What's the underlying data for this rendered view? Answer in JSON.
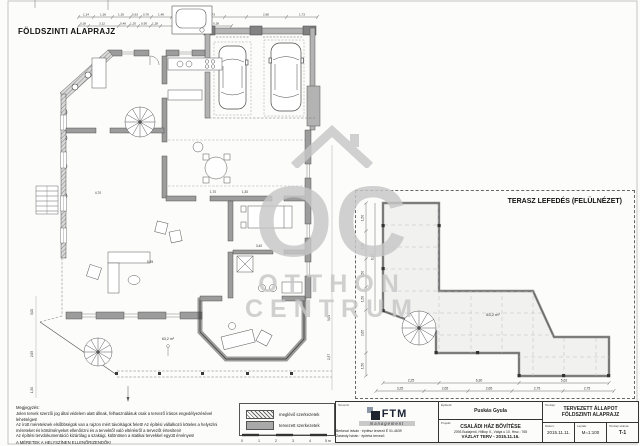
{
  "sheet": {
    "main_title": "FÖLDSZINTI ALAPRAJZ",
    "terrace_title": "TERASZ LEFEDÉS (FELÜLNÉZET)"
  },
  "watermark": {
    "oc": "OC",
    "line1": "OTTHON",
    "line2": "CENTRUM"
  },
  "main_plan": {
    "top_dims_row1": [
      "1,14",
      "1,36",
      "1,35",
      "0,63",
      "0,76",
      "1,48",
      "1,45",
      "0,74",
      "1,73",
      "2,80",
      "1,73"
    ],
    "top_dims_row2": [
      "0,38",
      "3,12",
      "0,48",
      "1,20",
      "0,90",
      "1,28",
      "2,39",
      "0,38"
    ],
    "area_label": "63,2 m²",
    "dims": {
      "d1": "1,70",
      "d2": "1,30",
      "d3": "3,40",
      "d4": "5,95",
      "d5": "4,70",
      "d6": "3,00",
      "d7": "2,65",
      "d8": "1,50",
      "d9": "3,04",
      "d10": "2,37"
    }
  },
  "terrace_plan": {
    "area_label": "63,2 m²",
    "bottom_dims_row1": [
      "2,25",
      "6,30",
      "5,62"
    ],
    "bottom_dims_row2": [
      "3,25",
      "2,65",
      "2,65",
      "2,75",
      "2,75"
    ],
    "left_dims": [
      "1,50",
      "1,50",
      "1,50",
      "1,50",
      "2,65",
      "1,50"
    ],
    "left_total": "6,92"
  },
  "notes": {
    "heading": "Megjegyzés:",
    "line1": "Jelen tervek szerzői jog által védelem alatt állnak, felhasználásuk csak a tervező írásos engedélyezésével lehetséges!",
    "line2": "Az írott méreteknek elsőbbségük van a rajzon mért távolságok felett! Az építési vállalkozó köteles a helyszíni méreteket és körülményeket ellenőrizni és a tervektől való eltérésről a tervezőt értesíteni!",
    "line3": "Az építési tervdokumentáció kizárólag a szakági, különösen a statikai tervekkel együtt érvényes!",
    "line4": "A MÉRETEK A HELYSZÍNEN ELLENŐRIZENDŐK!"
  },
  "legend": {
    "existing": "meglévő szerkezetek",
    "planned": "tervezett szerkezetek",
    "scale_numbers": [
      "0",
      "1",
      "2",
      "3",
      "4",
      "5 m"
    ]
  },
  "title_block": {
    "designer_label": "Tervező:",
    "logo_text": "FTM",
    "logo_sub": "management",
    "designer_line1": "Berkeczi István · építész tervező É 01-4639",
    "designer_line2": "Zarándy István · építész tervező",
    "client_label": "Építtető:",
    "client_name": "Puskás Gyula",
    "project_label": "Projekt:",
    "project_name": "CSALÁDI HÁZ BŐVÍTÉSE",
    "project_address": "2093 Budajenő, Hilltop II., Vátya u 10. Hrsz.: 765",
    "project_phase": "VÁZLAT TERV - 2015.11.16.",
    "sheet_label": "Tervlap:",
    "sheet_line1": "TERVEZETT ÁLLAPOT",
    "sheet_line2": "FÖLDSZINTI ALAPRAJZ",
    "date_label": "Dátum:",
    "date_value": "2015.11.11.",
    "scale_label": "Lépték:",
    "scale_value": "M=1:100",
    "sheetno_label": "Tervlap száma:",
    "sheetno_value": "T-1"
  },
  "colors": {
    "wall_gray": "#9c9c9c",
    "watermark": "#c7c7c7",
    "accent_dark": "#1d2430"
  }
}
